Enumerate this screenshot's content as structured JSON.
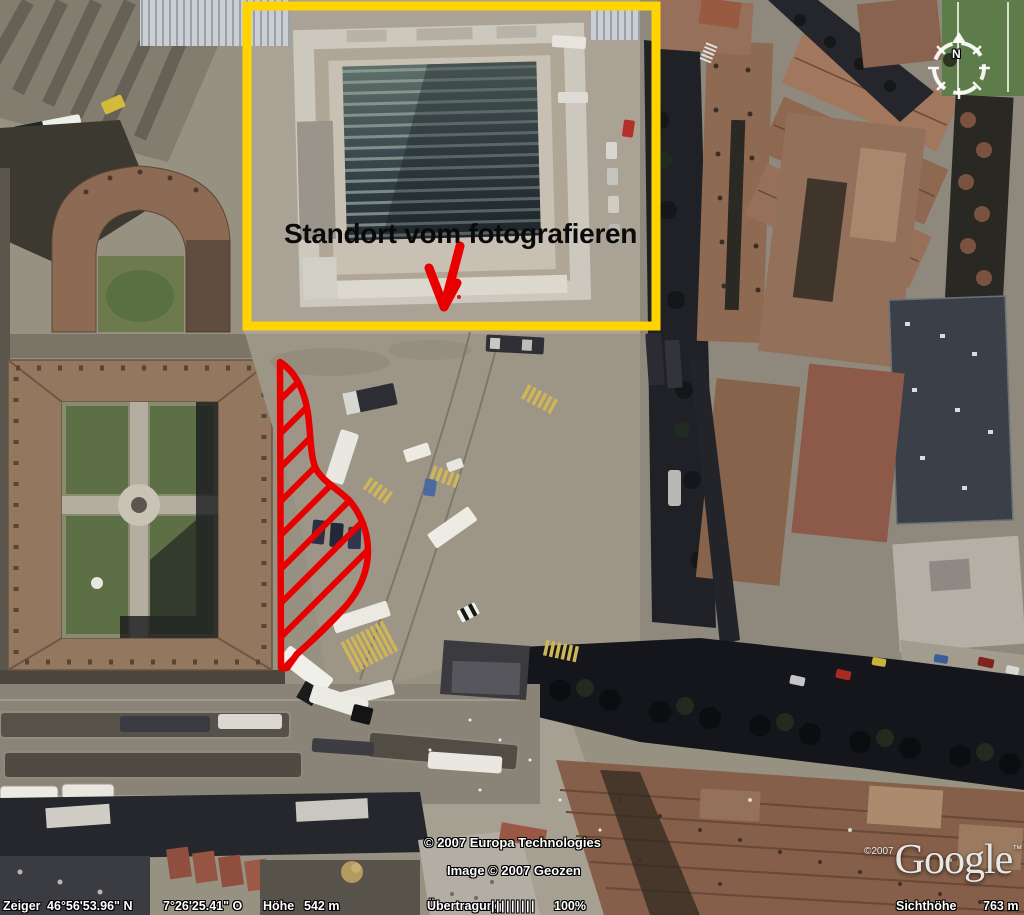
{
  "annotation": {
    "label": "Standort vom fotografieren"
  },
  "compass": {
    "north_label": "N"
  },
  "watermark": {
    "copyright_line1": "© 2007 Europa Technologies",
    "copyright_line2": "Image © 2007 Geozen",
    "logo_prefix": "©2007",
    "logo_text": "Google",
    "logo_suffix": "™"
  },
  "status_bar": {
    "pointer_label": "Zeiger",
    "latitude": "46°56'53.96\" N",
    "longitude": "7°26'25.41\" O",
    "altitude_label": "Höhe",
    "altitude_value": "542 m",
    "streaming_label": "Übertragung",
    "streaming_bars": "|||||||||",
    "streaming_percent": "100%",
    "eye_altitude_label": "Sichthöhe",
    "eye_altitude_value": "763 m"
  },
  "colors": {
    "highlight_box": "#ffd400",
    "marker_red": "#e80000",
    "label_text": "#0a0a0a"
  }
}
